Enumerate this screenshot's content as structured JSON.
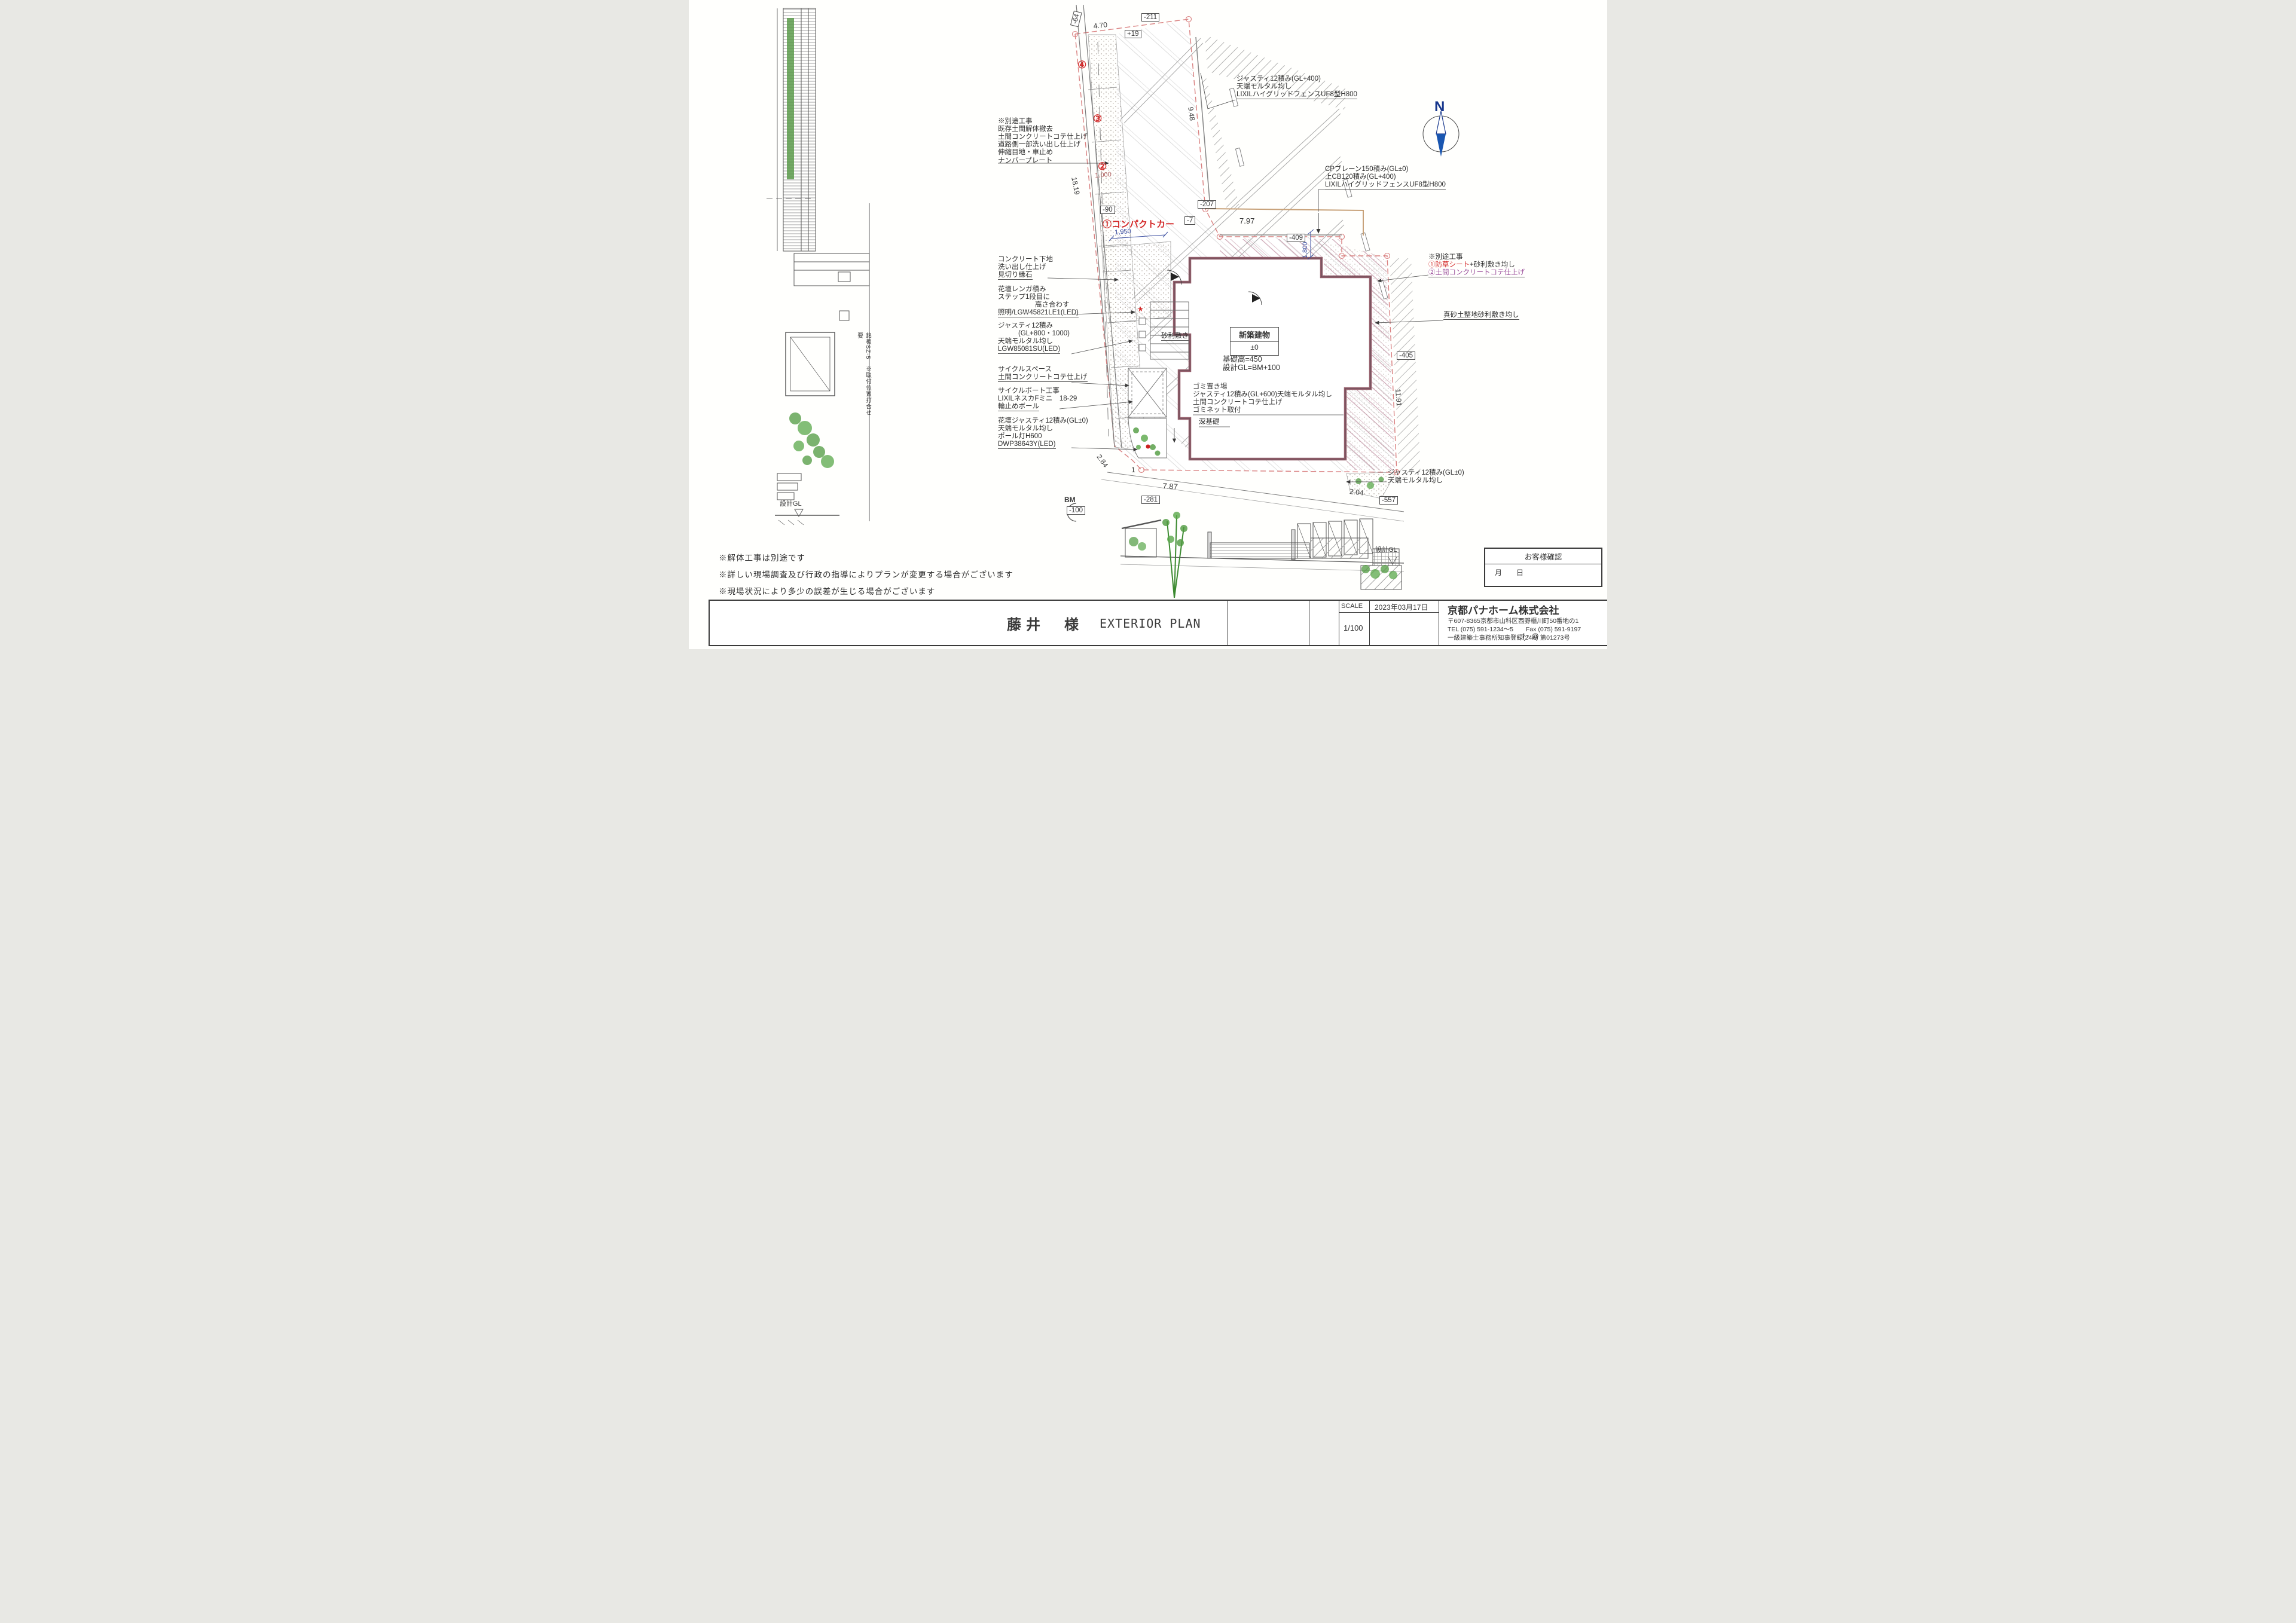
{
  "ann": {
    "fence_top": [
      "ジャスティ12積み(GL+400)",
      "天端モルタル均し",
      "LIXILハイグリッドフェンスUF8型H800"
    ],
    "cp": [
      "CPブレーン150積み(GL±0)",
      "上CB120積み(GL+400)",
      "LIXILハイグリッドフェンスUF8型H800"
    ],
    "road": [
      "※別途工事",
      "既存土間解体撤去",
      "土間コンクリートコテ仕上げ",
      "道路側一部洗い出し仕上げ",
      "伸縮目地・車止め",
      "ナンバープレート"
    ],
    "concrete": [
      "コンクリート下地",
      "洗い出し仕上げ",
      "見切り縁石"
    ],
    "brick": [
      "花壇レンガ積み",
      "ステップ1段目に",
      "高さ合わす",
      "照明/LGW45821LE1(LED)"
    ],
    "justy": [
      "ジャスティ12積み",
      "(GL+800・1000)",
      "天端モルタル均し",
      "LGW85081SU(LED)"
    ],
    "cyc_sp": [
      "サイクルスペース",
      "土間コンクリートコテ仕上げ"
    ],
    "cyc_port": [
      "サイクルポート工事",
      "LIXILネスカFミニ　18-29",
      "輪止めボール"
    ],
    "fl_justy": [
      "花壇ジャスティ12積み(GL±0)",
      "天端モルタル均し",
      "ポール灯H600",
      "DWP38643Y(LED)"
    ],
    "side": {
      "t": "※別途工事",
      "a1": "①防草シート",
      "a2": "+砂利敷き均し",
      "b": "②土間コンクリートコテ仕上げ"
    },
    "masa": "真砂土整地砂利敷き均し",
    "justy_b": [
      "ジャスティ12積み(GL±0)",
      "天端モルタル均し"
    ],
    "gravel": "砂利敷き",
    "bldg": {
      "name": "新築建物",
      "level": "±0",
      "l1": "基礎高=450",
      "l2": "設計GL=BM+100"
    },
    "garbage": [
      "ゴミ置き場",
      "ジャスティ12積み(GL+600)天端モルタル均し",
      "土間コンクリートコテ仕上げ",
      "ゴミネット取付"
    ],
    "deep": "深基礎",
    "compact": "①コンパクトカー",
    "vnote": "銘板SZ-5　※取付位置打合せ要"
  },
  "dims": {
    "d470": "4.70",
    "d948": "9.48",
    "d1819": "18.19",
    "d797": "7.97",
    "d787": "7.87",
    "d284": "2.84",
    "d204": "2.04",
    "d1191": "11.91",
    "d1000": "1,000",
    "d1950": "1,950",
    "d1800": "1,800",
    "d1": "1"
  },
  "levels": {
    "m64": "-64",
    "m211": "-211",
    "p19": "+19",
    "m90": "-90",
    "m7": "-7",
    "m207": "-207",
    "m409": "-409",
    "m405": "-405",
    "m281": "-281",
    "m557": "-557",
    "m100": "-100",
    "bm": "BM"
  },
  "circled": {
    "c1": "①",
    "c2": "②",
    "c3": "③",
    "c4": "④"
  },
  "notes": [
    "※解体工事は別途です",
    "※詳しい現場調査及び行政の指導によりプランが変更する場合がございます",
    "※現場状況により多少の誤差が生じる場合がございます"
  ],
  "tb": {
    "client": "藤井　様",
    "plan": "EXTERIOR PLAN",
    "scale_label": "SCALE",
    "scale_value": "1/100",
    "date": "2023年03月17日",
    "company": "京都パナホーム株式会社",
    "address": "〒607-8365京都市山科区西野櫃川町50番地の1",
    "tel": "TEL (075) 591-1234〜5　　Fax (075) 591-9197",
    "license": "一級建築士事務所知事登録(24A) 第01273号",
    "mark": "f・@"
  },
  "cust": {
    "title": "お客様確認",
    "row": "月　　日"
  },
  "misc": {
    "north": "N",
    "gl": "設計GL",
    "tri": "▽",
    "star": "★"
  }
}
